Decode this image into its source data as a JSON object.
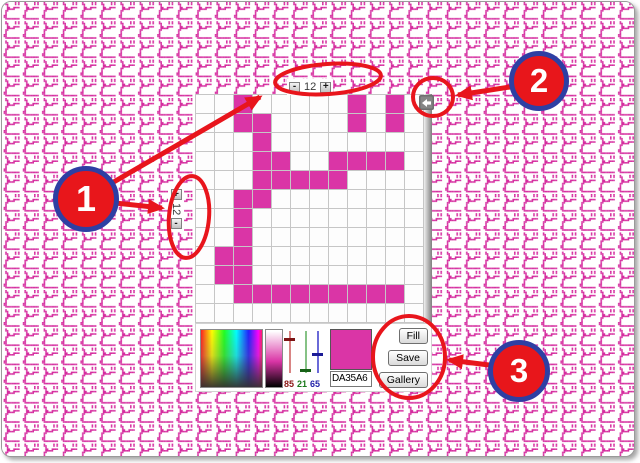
{
  "background": {
    "tile_color": "#d52d9f"
  },
  "grid": {
    "size": 12,
    "cell_color": "#da35a6",
    "rows": [
      "..X.....X.X.",
      "..XX....X.X.",
      "...X........",
      "...XX..XXXX.",
      "...XXXXX....",
      "..XX........",
      "..X.........",
      "..X.........",
      ".XX.........",
      ".XX.........",
      "..XXXXXXXXX.",
      "............"
    ]
  },
  "steppers": {
    "columns": {
      "decrease_label": "-",
      "value": "12",
      "increase_label": "+"
    },
    "rows": {
      "increase_label": "+",
      "value": "12",
      "decrease_label": "-"
    }
  },
  "picker": {
    "rgb_sliders": [
      {
        "channel": "red",
        "value": "85",
        "line_color": "#d98484",
        "handle_color": "#7d1414",
        "label_color": "#8b1616"
      },
      {
        "channel": "green",
        "value": "21",
        "line_color": "#86c286",
        "handle_color": "#176117",
        "label_color": "#1a7a1a"
      },
      {
        "channel": "blue",
        "value": "65",
        "line_color": "#6a6ad8",
        "handle_color": "#1b1b96",
        "label_color": "#2222aa"
      }
    ],
    "swatch_color": "#da35a6",
    "hex_value": "DA35A6",
    "buttons": [
      {
        "label": "Fill"
      },
      {
        "label": "Save"
      },
      {
        "label": "Gallery"
      }
    ]
  },
  "annotations": {
    "accent_red": "#e8151c",
    "circle_fill": "#e8161b",
    "circle_border": "#2e3fa3",
    "callouts": [
      {
        "number": "1"
      },
      {
        "number": "2"
      },
      {
        "number": "3"
      }
    ]
  }
}
